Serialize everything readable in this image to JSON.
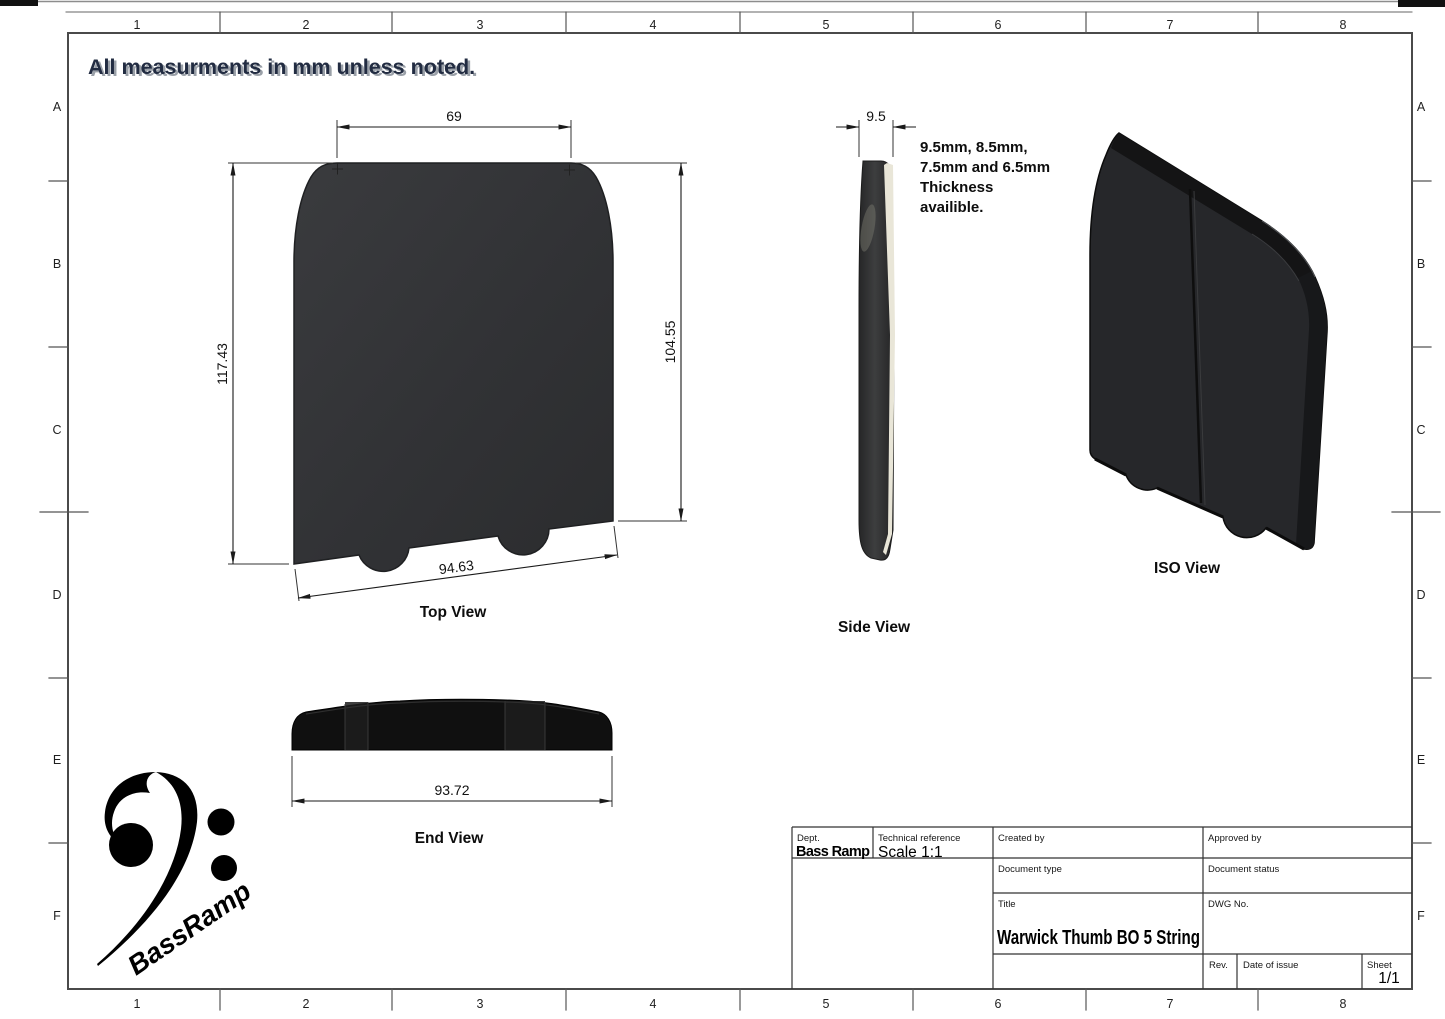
{
  "sheet": {
    "heading": "All measurments in mm unless noted.",
    "zone_columns": [
      "1",
      "2",
      "3",
      "4",
      "5",
      "6",
      "7",
      "8"
    ],
    "zone_rows": [
      "A",
      "B",
      "C",
      "D",
      "E",
      "F"
    ]
  },
  "views": {
    "top": {
      "label": "Top View",
      "dim_top_width": "69",
      "dim_left_height": "117.43",
      "dim_right_height": "104.55",
      "dim_bottom_width": "94.63"
    },
    "side": {
      "label": "Side View",
      "dim_thickness": "9.5",
      "note_line1": "9.5mm, 8.5mm,",
      "note_line2": "7.5mm and 6.5mm",
      "note_line3": "Thickness",
      "note_line4": "availible."
    },
    "iso": {
      "label": "ISO View"
    },
    "end": {
      "label": "End View",
      "dim_width": "93.72"
    }
  },
  "title_block": {
    "dept_label": "Dept.",
    "dept_value": "Bass Ramp",
    "technical_reference_label": "Technical reference",
    "technical_reference_value": "Scale 1:1",
    "created_by_label": "Created by",
    "approved_by_label": "Approved by",
    "document_type_label": "Document type",
    "document_status_label": "Document status",
    "title_label": "Title",
    "title_value": "Warwick Thumb BO 5 String",
    "dwg_no_label": "DWG No.",
    "rev_label": "Rev.",
    "date_of_issue_label": "Date of issue",
    "sheet_label": "Sheet",
    "sheet_value": "1/1"
  },
  "logo": {
    "text": "BassRamp"
  },
  "colors": {
    "part_dark": "#2e2f31",
    "part_cream": "#e9e6d8",
    "heading_navy": "#222c42",
    "frame_gray": "#4a4a4a"
  }
}
